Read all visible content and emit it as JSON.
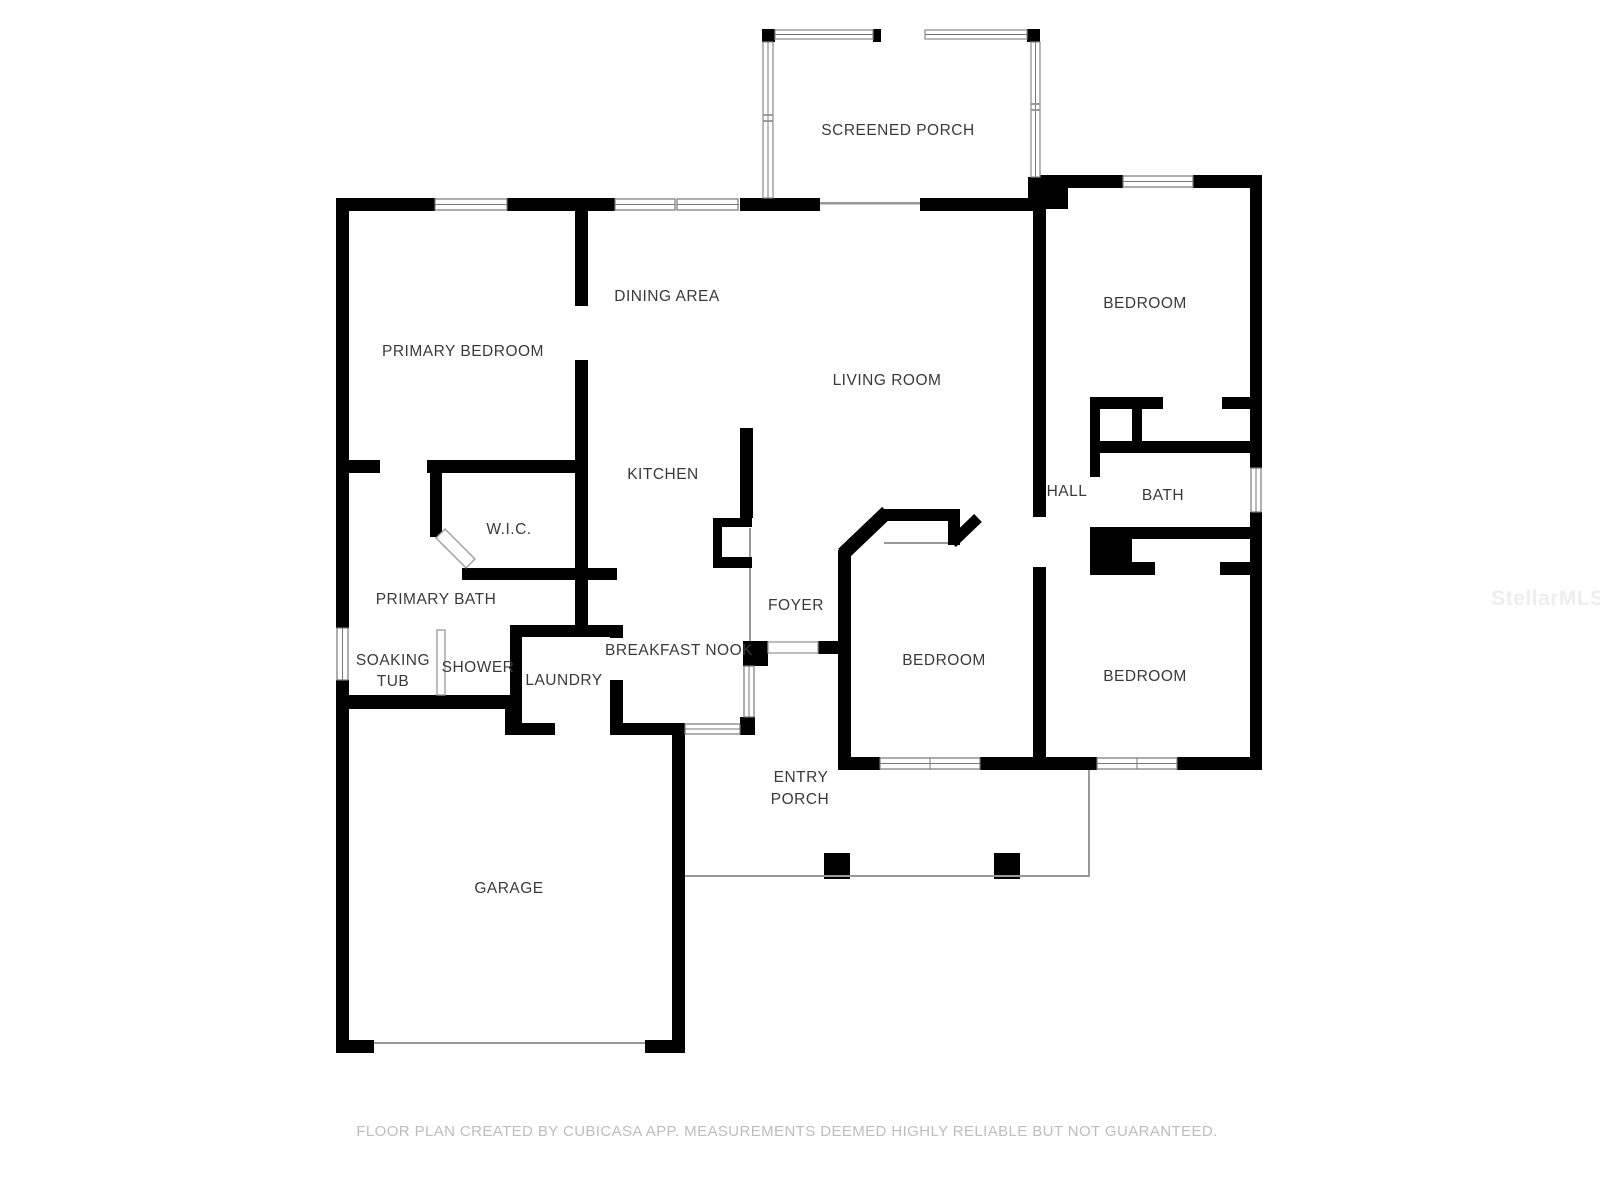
{
  "plan": {
    "rooms": {
      "screened_porch": "SCREENED PORCH",
      "primary_bedroom": "PRIMARY BEDROOM",
      "dining_area": "DINING AREA",
      "living_room": "LIVING ROOM",
      "bedroom_top_right": "BEDROOM",
      "kitchen": "KITCHEN",
      "wic": "W.I.C.",
      "hall": "HALL",
      "bath": "BATH",
      "primary_bath": "PRIMARY BATH",
      "soaking_tub_line1": "SOAKING",
      "soaking_tub_line2": "TUB",
      "shower": "SHOWER",
      "laundry": "LAUNDRY",
      "breakfast_nook": "BREAKFAST NOOK",
      "foyer": "FOYER",
      "bedroom_middle": "BEDROOM",
      "bedroom_right": "BEDROOM",
      "entry_porch_line1": "ENTRY",
      "entry_porch_line2": "PORCH",
      "garage": "GARAGE"
    },
    "footer": "FLOOR PLAN CREATED BY CUBICASA APP. MEASUREMENTS DEEMED HIGHLY RELIABLE BUT NOT GUARANTEED.",
    "watermark": "StellarMLS",
    "colors": {
      "wall": "#000000",
      "label_text": "#3a3a3a",
      "footer_text": "#bdbdbd",
      "watermark_text": "#ededed",
      "thin_line": "#999999",
      "background": "#ffffff"
    }
  }
}
